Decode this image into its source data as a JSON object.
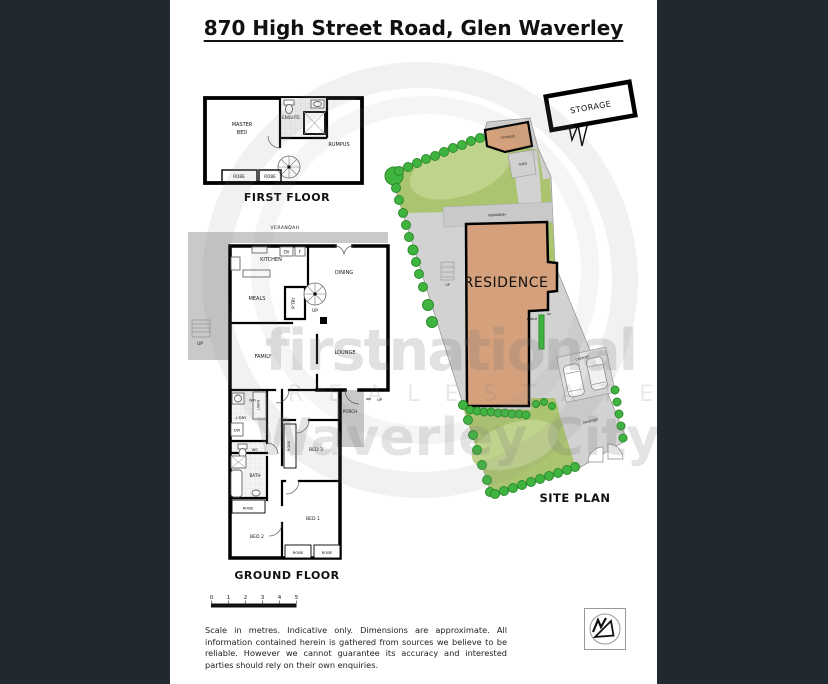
{
  "page": {
    "title": "870 High Street Road, Glen Waverley"
  },
  "first_floor": {
    "caption": "FIRST FLOOR",
    "labels": {
      "master_bed_line1": "MASTER",
      "master_bed_line2": "BED",
      "ensuite": "ENSUITE",
      "rumpus": "RUMPUS",
      "robe_left": "ROBE",
      "robe_right": "ROBE"
    }
  },
  "ground_floor": {
    "caption": "GROUND FLOOR",
    "labels": {
      "verandah": "VERANDAH",
      "kitchen": "KITCHEN",
      "ov": "OV",
      "f": "F",
      "dining": "DINING",
      "meals": "MEALS",
      "pantry": "P'TRY",
      "stair_up": "UP",
      "deck_up": "UP",
      "family": "FAMILY",
      "lounge": "LOUNGE",
      "wm": "WM",
      "linen": "LINEN",
      "laundry": "L'DRY",
      "dw": "DW",
      "wc": "WC",
      "bath": "BATH",
      "robe_hall": "ROBE",
      "bed2": "BED 2",
      "bed3": "BED 3",
      "robe_bed3": "ROBE",
      "bed1": "BED 1",
      "robe_bed1_left": "ROBE",
      "robe_bed1_right": "ROBE",
      "porch": "PORCH",
      "porch_up": "UP"
    }
  },
  "site_plan": {
    "caption": "SITE PLAN",
    "callout": "STORAGE",
    "labels": {
      "storage": "STORAGE",
      "shed": "SHED",
      "verandah": "VERANDAH",
      "residence": "RESIDENCE",
      "deck_up": "UP",
      "porch": "PORCH",
      "porch_up": "UP",
      "carport": "CARPORT",
      "driveway": "DRIVEWAY"
    }
  },
  "watermark": {
    "line1": "firstnational",
    "line2": "R E A L   E S T A T E",
    "line3": "Waverley City"
  },
  "scale_bar": {
    "ticks": [
      "0",
      "1",
      "2",
      "3",
      "4",
      "5"
    ]
  },
  "disclaimer": "Scale in metres. Indicative only. Dimensions are approximate.  All information contained herein is gathered from sources we believe to be reliable.  However we cannot guarantee its accuracy and interested parties should rely on their own enquiries.",
  "colors": {
    "sidebar": "#212830",
    "paving": "#d2d2d2",
    "deck_gray": "#c9c9c9",
    "lawn": "#abc46f",
    "lawn_light": "#c0d38c",
    "tree": "#3fb53f",
    "residence": "#d5a17c"
  }
}
